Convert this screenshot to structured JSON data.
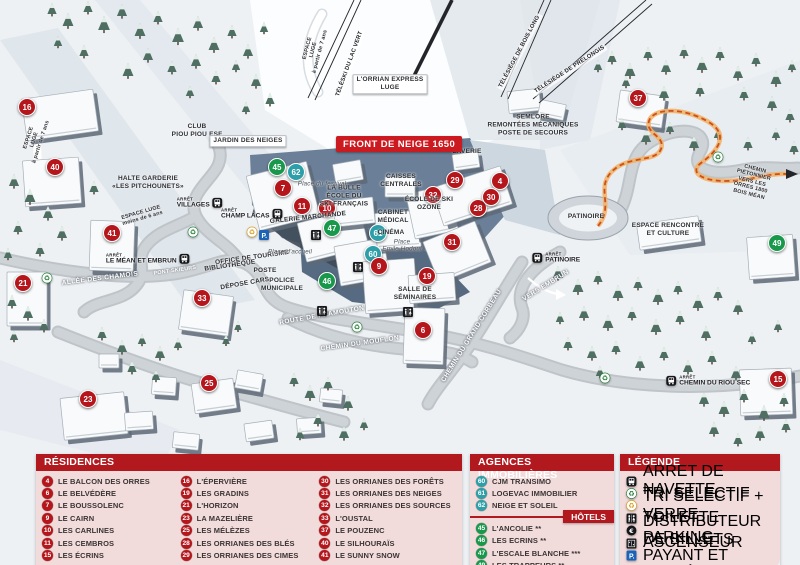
{
  "front_banner": "FRONT DE NEIGE 1650",
  "colors": {
    "residence": "#b5161c",
    "agence": "#2d9fa8",
    "hotel": "#17984a",
    "header_bg": "#b2191f",
    "panel_bg": "#f2dbdb",
    "banner_bg": "#cb1a20",
    "trail_dash": "#cc4f1a"
  },
  "map": {
    "arret_label": "ARRÊT",
    "markers": [
      {
        "n": "16",
        "t": "residence",
        "x": 27,
        "y": 107
      },
      {
        "n": "40",
        "t": "residence",
        "x": 55,
        "y": 167
      },
      {
        "n": "41",
        "t": "residence",
        "x": 112,
        "y": 233
      },
      {
        "n": "21",
        "t": "residence",
        "x": 23,
        "y": 283
      },
      {
        "n": "33",
        "t": "residence",
        "x": 202,
        "y": 298
      },
      {
        "n": "23",
        "t": "residence",
        "x": 88,
        "y": 399
      },
      {
        "n": "25",
        "t": "residence",
        "x": 209,
        "y": 383
      },
      {
        "n": "45",
        "t": "hotel",
        "x": 277,
        "y": 167
      },
      {
        "n": "62",
        "t": "agence",
        "x": 296,
        "y": 172
      },
      {
        "n": "7",
        "t": "residence",
        "x": 283,
        "y": 188
      },
      {
        "n": "11",
        "t": "residence",
        "x": 302,
        "y": 206
      },
      {
        "n": "10",
        "t": "residence",
        "x": 327,
        "y": 208
      },
      {
        "n": "47",
        "t": "hotel",
        "x": 332,
        "y": 228
      },
      {
        "n": "61",
        "t": "agence",
        "x": 378,
        "y": 233
      },
      {
        "n": "60",
        "t": "agence",
        "x": 373,
        "y": 254
      },
      {
        "n": "9",
        "t": "residence",
        "x": 379,
        "y": 266
      },
      {
        "n": "46",
        "t": "hotel",
        "x": 327,
        "y": 281
      },
      {
        "n": "19",
        "t": "residence",
        "x": 427,
        "y": 276
      },
      {
        "n": "6",
        "t": "residence",
        "x": 423,
        "y": 330
      },
      {
        "n": "31",
        "t": "residence",
        "x": 452,
        "y": 242
      },
      {
        "n": "28",
        "t": "residence",
        "x": 478,
        "y": 208
      },
      {
        "n": "29",
        "t": "residence",
        "x": 455,
        "y": 180
      },
      {
        "n": "4",
        "t": "residence",
        "x": 500,
        "y": 181
      },
      {
        "n": "32",
        "t": "residence",
        "x": 433,
        "y": 195
      },
      {
        "n": "30",
        "t": "residence",
        "x": 491,
        "y": 197
      },
      {
        "n": "37",
        "t": "residence",
        "x": 638,
        "y": 98
      },
      {
        "n": "49",
        "t": "hotel",
        "x": 777,
        "y": 243
      },
      {
        "n": "15",
        "t": "residence",
        "x": 778,
        "y": 379
      }
    ],
    "labels": [
      {
        "text": "CLUB\nPIOU PIOU ESF",
        "x": 197,
        "y": 131
      },
      {
        "text": "JARDIN DES NEIGES",
        "x": 248,
        "y": 141,
        "cls": "box"
      },
      {
        "text": "HALTE GARDERIE\n«LES PITCHOUNETS»",
        "x": 148,
        "y": 183
      },
      {
        "text": "ESPACE\nLUGE\nà partir de 7 ans",
        "x": 35,
        "y": 140,
        "rot": -72,
        "cls": "dark-micro"
      },
      {
        "text": "ESPACE\nLUGE\nà partir de 7 ans",
        "x": 314,
        "y": 50,
        "rot": -75,
        "cls": "dark-micro"
      },
      {
        "text": "ESPACE LUGE\nmoins de 6 ans",
        "x": 142,
        "y": 216,
        "rot": -16,
        "cls": "dark-micro"
      },
      {
        "text": "L'ORRIAN EXPRESS\nLUGE",
        "x": 390,
        "y": 84,
        "cls": "box"
      },
      {
        "text": "TÉLÉSKI DU LAC VERT",
        "x": 350,
        "y": 64,
        "rot": -70,
        "cls": "lift"
      },
      {
        "text": "TÉLÉSIÈGE DE BOIS LONG",
        "x": 520,
        "y": 52,
        "rot": -62,
        "cls": "lift"
      },
      {
        "text": "TÉLÉSIÈGE DE PRÉLONGIS",
        "x": 570,
        "y": 70,
        "rot": -33,
        "cls": "lift"
      },
      {
        "text": "SEMLORE\nREMONTÉES MÉCANIQUES\nPOSTE DE SECOURS",
        "x": 533,
        "y": 125
      },
      {
        "text": "LAVERIE",
        "x": 467,
        "y": 152
      },
      {
        "text": "CAISSES\nCENTRALES",
        "x": 401,
        "y": 181
      },
      {
        "text": "LA BULLE\nÉCOLE DU\nSKI FRANÇAIS",
        "x": 344,
        "y": 196
      },
      {
        "text": "Place du festival",
        "x": 322,
        "y": 184,
        "cls": "place"
      },
      {
        "text": "ÉCOLE DE SKI\nOZONE",
        "x": 429,
        "y": 204
      },
      {
        "text": "CABINET\nMÉDICAL",
        "x": 393,
        "y": 217
      },
      {
        "text": "CINÉMA",
        "x": 391,
        "y": 233
      },
      {
        "text": "Place\nEmile Hodoul",
        "x": 402,
        "y": 246,
        "cls": "place"
      },
      {
        "text": "GALERIE MARCHANDE",
        "x": 308,
        "y": 218,
        "rot": -6
      },
      {
        "text": "OFFICE DE TOURISME",
        "x": 252,
        "y": 258,
        "rot": -8
      },
      {
        "text": "BIBLIOTHÈQUE",
        "x": 230,
        "y": 266,
        "rot": -8
      },
      {
        "text": "POSTE",
        "x": 265,
        "y": 271
      },
      {
        "text": "DÉPOSE CARS",
        "x": 245,
        "y": 284,
        "rot": -10
      },
      {
        "text": "POLICE\nMUNICIPALE",
        "x": 282,
        "y": 285
      },
      {
        "text": "Place d'accueil",
        "x": 290,
        "y": 252,
        "cls": "place"
      },
      {
        "text": "SALLE DE\nSÉMINAIRES",
        "x": 415,
        "y": 294
      },
      {
        "text": "ROUTE DE PRAMOUTON",
        "x": 322,
        "y": 316,
        "rot": -10,
        "cls": "road"
      },
      {
        "text": "CHEMIN DU MOUFLON",
        "x": 360,
        "y": 344,
        "rot": -8,
        "cls": "road"
      },
      {
        "text": "CHEMIN DU GRAND CORBEAU",
        "x": 472,
        "y": 336,
        "rot": -58,
        "cls": "road"
      },
      {
        "text": "ALLÉE DES CHAMOIS",
        "x": 100,
        "y": 279,
        "rot": -7,
        "cls": "road"
      },
      {
        "text": "PONT SKIEURS",
        "x": 175,
        "y": 271,
        "rot": -8,
        "cls": "road-tiny"
      },
      {
        "text": "VERS EMBRUN",
        "x": 546,
        "y": 286,
        "rot": -32,
        "cls": "road"
      },
      {
        "text": "PATINOIRE",
        "x": 586,
        "y": 217
      },
      {
        "text": "ESPACE RENCONTRE\nET CULTURE",
        "x": 668,
        "y": 230
      },
      {
        "text": "CHEMIN PIÉTONNIER\nVERS LES ORRES 1800\nBOIS MÉAN",
        "x": 752,
        "y": 182,
        "rot": 14,
        "cls": "dark-micro"
      }
    ],
    "stops": [
      {
        "name": "VILLAGES",
        "x": 200,
        "y": 203,
        "side": "right"
      },
      {
        "name": "CHAMP LACAS",
        "x": 252,
        "y": 214,
        "side": "right"
      },
      {
        "name": "LE MÉAN ET EMBRUN",
        "x": 148,
        "y": 259,
        "side": "right"
      },
      {
        "name": "PATINOIRE",
        "x": 556,
        "y": 258,
        "side": "left"
      },
      {
        "name": "CHEMIN DU RIOU SEC",
        "x": 708,
        "y": 381,
        "side": "left"
      }
    ],
    "icons": [
      {
        "k": "recycle-green",
        "x": 193,
        "y": 232
      },
      {
        "k": "recycle-green",
        "x": 47,
        "y": 278
      },
      {
        "k": "recycle-green",
        "x": 357,
        "y": 327
      },
      {
        "k": "recycle-green",
        "x": 718,
        "y": 157
      },
      {
        "k": "recycle-green",
        "x": 605,
        "y": 378
      },
      {
        "k": "recycle-yellow",
        "x": 252,
        "y": 232
      },
      {
        "k": "toilet",
        "x": 316,
        "y": 235
      },
      {
        "k": "toilet",
        "x": 358,
        "y": 267
      },
      {
        "k": "toilet",
        "x": 322,
        "y": 311
      },
      {
        "k": "toilet",
        "x": 408,
        "y": 312
      },
      {
        "k": "parking",
        "x": 264,
        "y": 235
      }
    ]
  },
  "legend": {
    "residences": {
      "title": "RÉSIDENCES",
      "items": [
        {
          "n": "4",
          "label": "LE BALCON DES ORRES"
        },
        {
          "n": "6",
          "label": "LE BELVÉDÈRE"
        },
        {
          "n": "7",
          "label": "LE BOUSSOLENC"
        },
        {
          "n": "9",
          "label": "LE CAIRN"
        },
        {
          "n": "10",
          "label": "LES CARLINES"
        },
        {
          "n": "11",
          "label": "LES CEMBROS"
        },
        {
          "n": "15",
          "label": "LES ÉCRINS"
        },
        {
          "n": "16",
          "label": "L'ÉPERVIÈRE"
        },
        {
          "n": "19",
          "label": "LES GRADINS"
        },
        {
          "n": "21",
          "label": "L'HORIZON"
        },
        {
          "n": "23",
          "label": "LA MAZELIÈRE"
        },
        {
          "n": "25",
          "label": "LES MÉLÈZES"
        },
        {
          "n": "28",
          "label": "LES ORRIANES DES BLÉS"
        },
        {
          "n": "29",
          "label": "LES ORRIANES DES CIMES"
        },
        {
          "n": "30",
          "label": "LES ORRIANES DES FORÊTS"
        },
        {
          "n": "31",
          "label": "LES ORRIANES DES NEIGES"
        },
        {
          "n": "32",
          "label": "LES ORRIANES DES SOURCES"
        },
        {
          "n": "33",
          "label": "L'OUSTAL"
        },
        {
          "n": "37",
          "label": "LE POUZENC"
        },
        {
          "n": "40",
          "label": "LE SILHOURAÏS"
        },
        {
          "n": "41",
          "label": "LE SUNNY SNOW"
        }
      ]
    },
    "agences": {
      "title": "AGENCES IMMOBILIÈRES",
      "items": [
        {
          "n": "60",
          "label": "CJM TRANSIMO"
        },
        {
          "n": "61",
          "label": "LOGEVAC IMMOBILIER"
        },
        {
          "n": "62",
          "label": "NEIGE ET SOLEIL"
        }
      ]
    },
    "hotels": {
      "title": "HÔTELS",
      "items": [
        {
          "n": "45",
          "label": "L'ANCOLIE **"
        },
        {
          "n": "46",
          "label": "LES ECRINS **"
        },
        {
          "n": "47",
          "label": "L'ESCALE BLANCHE ***"
        },
        {
          "n": "49",
          "label": "LES TRAPPEURS **"
        }
      ]
    },
    "legende": {
      "title": "LÉGENDE",
      "items": [
        {
          "icon": "bus",
          "label": "ARRET DE NAVETTE"
        },
        {
          "icon": "recycle-green",
          "label": "TRI SELECTIF"
        },
        {
          "icon": "recycle-yellow",
          "label": "TRI SELECTIF + VERRE"
        },
        {
          "icon": "toilet",
          "label": "TOILETTE"
        },
        {
          "icon": "euro",
          "label": "DISTRIBUTEUR DE BILLETS"
        },
        {
          "icon": "elevator",
          "label": "ASCENSEUR"
        },
        {
          "icon": "parking",
          "label": "PARKING PAYANT ET LIMITÉ"
        }
      ]
    }
  }
}
